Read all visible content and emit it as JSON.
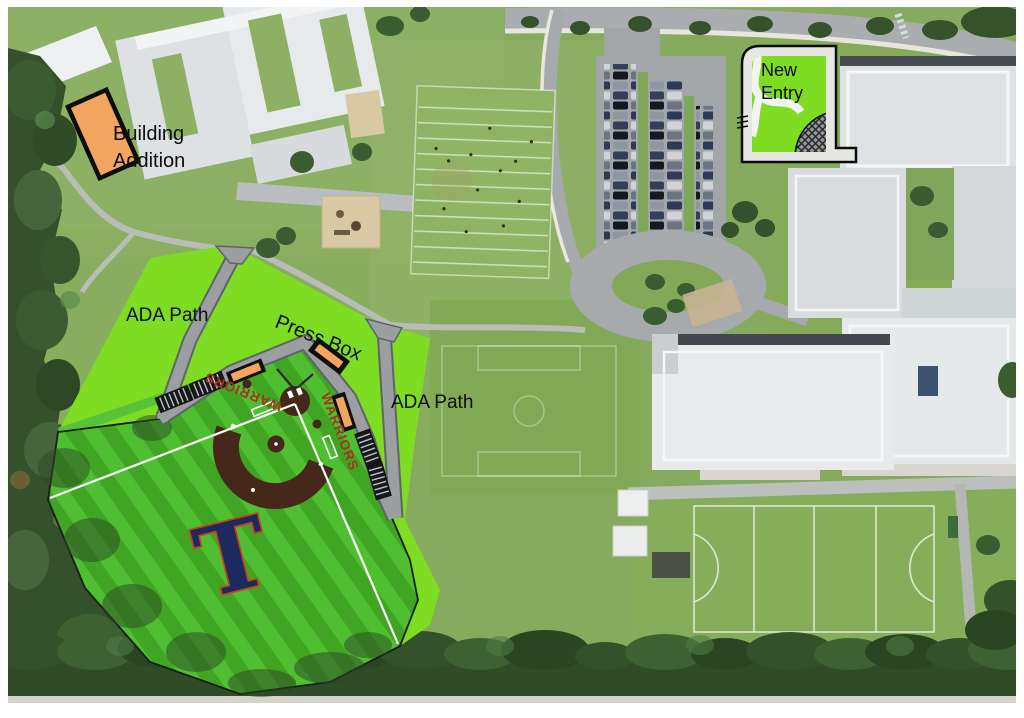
{
  "labels": {
    "building_addition": "Building Addition",
    "ada_path_west": "ADA Path",
    "press_box": "Press Box",
    "ada_path_east": "ADA Path",
    "new_entry": "New Entry"
  },
  "field": {
    "team_name_third_base": "WARRIORS",
    "team_name_first_base": "WARRIORS",
    "outfield_logo": "T"
  },
  "colors": {
    "site_overlay_green": "#7edd22",
    "outfield_stripe_light": "#4fbe30",
    "outfield_stripe_dark": "#3fa522",
    "infield_dirt_brown": "#46281a",
    "structure_orange": "#f2a55f",
    "ada_path_gray": "#9b9fa2",
    "team_text_red": "#a8331f",
    "logo_navy": "#1c2a5e",
    "logo_outline_red": "#c8431f"
  }
}
